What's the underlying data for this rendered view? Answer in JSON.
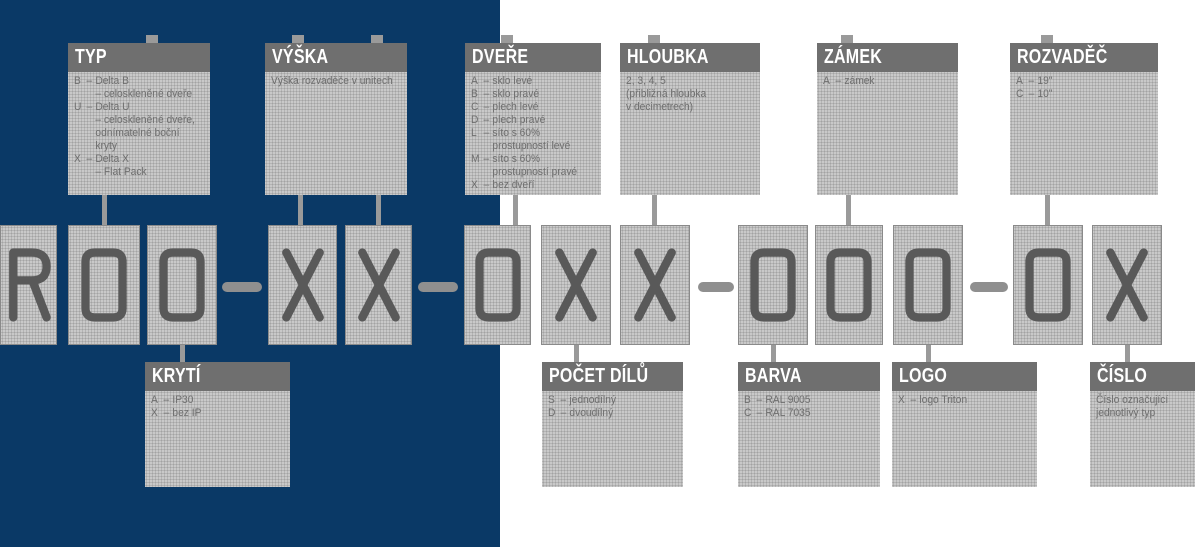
{
  "colors": {
    "panel_blue": "#0a3966",
    "header_gray": "#6f6f6f",
    "header_text": "#ffffff",
    "box_fill": "#cfcfcf",
    "box_dot": "#a3a3a3",
    "box_border": "#8a8a8a",
    "glyph_gray": "#595959",
    "connector_gray": "#9a9a9a",
    "dash_gray": "#8f8f8f",
    "body_text": "#6e6e6e"
  },
  "ui": {
    "item_separator": "–"
  },
  "code": {
    "characters": [
      "R",
      "0",
      "0",
      "-",
      "X",
      "X",
      "-",
      "0",
      "X",
      "X",
      "-",
      "0",
      "0",
      "0",
      "-",
      "0",
      "X"
    ]
  },
  "boxes": {
    "typ": {
      "title": "TYP",
      "items": [
        {
          "key": "B",
          "text": "Delta B\n– celoskleněné dveře"
        },
        {
          "key": "U",
          "text": "Delta U\n– celoskleněné dveře,\nodnímatelné boční\nkryty"
        },
        {
          "key": "X",
          "text": "Delta X\n– Flat Pack"
        }
      ]
    },
    "vyska": {
      "title": "VÝŠKA",
      "note": "Výška rozvaděče v unitech"
    },
    "dvere": {
      "title": "DVEŘE",
      "items": [
        {
          "key": "A",
          "text": "sklo levé"
        },
        {
          "key": "B",
          "text": "sklo pravé"
        },
        {
          "key": "C",
          "text": "plech levé"
        },
        {
          "key": "D",
          "text": "plech pravé"
        },
        {
          "key": "L",
          "text": "síto s 60%\nprostupností levé"
        },
        {
          "key": "M",
          "text": "síto s 60%\nprostupností pravé"
        },
        {
          "key": "X",
          "text": "bez dveří"
        }
      ]
    },
    "hloubka": {
      "title": "HLOUBKA",
      "note": "2, 3, 4, 5\n(přibližná hloubka\nv decimetrech)"
    },
    "zamek": {
      "title": "ZÁMEK",
      "items": [
        {
          "key": "A",
          "text": "zámek"
        }
      ]
    },
    "rozvadec": {
      "title": "ROZVADĚČ",
      "items": [
        {
          "key": "A",
          "text": "19\""
        },
        {
          "key": "C",
          "text": "10\""
        }
      ]
    },
    "kryti": {
      "title": "KRYTÍ",
      "items": [
        {
          "key": "A",
          "text": "IP30"
        },
        {
          "key": "X",
          "text": "bez IP"
        }
      ]
    },
    "pocet_dilu": {
      "title": "POČET DÍLŮ",
      "items": [
        {
          "key": "S",
          "text": "jednodílný"
        },
        {
          "key": "D",
          "text": "dvoudílný"
        }
      ]
    },
    "barva": {
      "title": "BARVA",
      "items": [
        {
          "key": "B",
          "text": "RAL 9005"
        },
        {
          "key": "C",
          "text": "RAL 7035"
        }
      ]
    },
    "logo": {
      "title": "LOGO",
      "items": [
        {
          "key": "X",
          "text": "logo Triton"
        }
      ]
    },
    "cislo": {
      "title": "ČÍSLO",
      "note": "Číslo označující\njednotlivý typ"
    }
  }
}
